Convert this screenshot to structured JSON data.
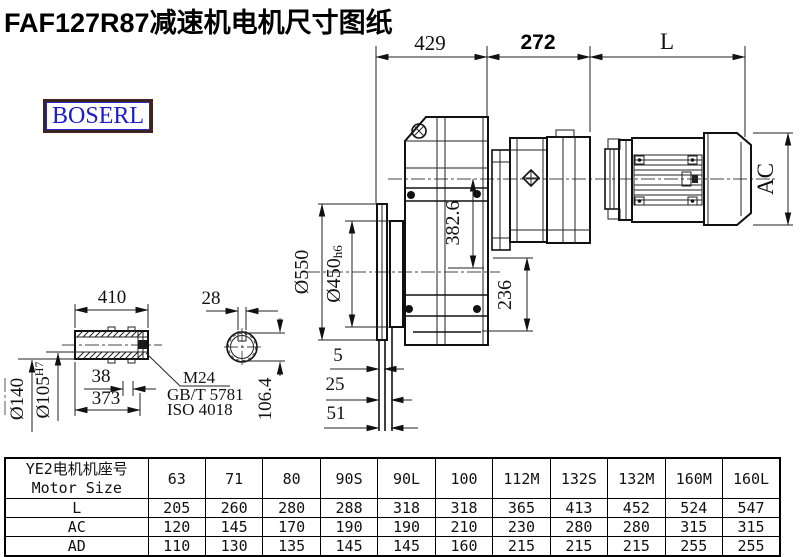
{
  "title": "FAF127R87减速机电机尺寸图纸",
  "logo": {
    "text": "BOSERL"
  },
  "drawing": {
    "top_dims": {
      "d429": "429",
      "d272": "272",
      "dL": "L"
    },
    "gearbox": {
      "dia550": "Ø550",
      "dia450": "Ø450",
      "dia450_tol": "h6",
      "h382": "382.6",
      "h236": "236"
    },
    "motor": {
      "ac": "AC"
    },
    "flange": {
      "p5": "5",
      "p25": "25",
      "p51": "51"
    },
    "shaft": {
      "len410": "410",
      "key28": "28",
      "dia140": "Ø140",
      "dia105": "Ø105",
      "dia105_tol": "H7",
      "d38": "38",
      "d373": "373",
      "thread": "M24",
      "std_gb": "GB/T 5781",
      "std_iso": "ISO 4018",
      "h1064": "106.4"
    }
  },
  "table": {
    "header_cn": "YE2电机机座号",
    "header_en": "Motor Size",
    "columns": [
      "63",
      "71",
      "80",
      "90S",
      "90L",
      "100",
      "112M",
      "132S",
      "132M",
      "160M",
      "160L"
    ],
    "rows": [
      {
        "label": "L",
        "values": [
          "205",
          "260",
          "280",
          "288",
          "318",
          "318",
          "365",
          "413",
          "452",
          "524",
          "547"
        ]
      },
      {
        "label": "AC",
        "values": [
          "120",
          "145",
          "170",
          "190",
          "190",
          "210",
          "230",
          "280",
          "280",
          "315",
          "315"
        ]
      },
      {
        "label": "AD",
        "values": [
          "110",
          "130",
          "135",
          "145",
          "145",
          "160",
          "215",
          "215",
          "215",
          "255",
          "255"
        ]
      }
    ]
  }
}
